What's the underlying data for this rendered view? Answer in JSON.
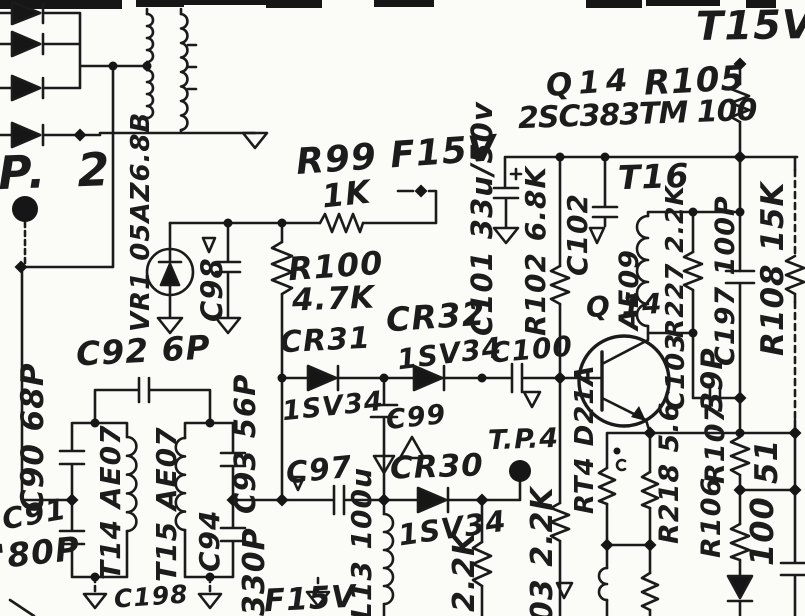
{
  "meta": {
    "figure_type": "hand-drawn circuit schematic (scanned)",
    "ink_color": "#1a1a1a",
    "paper_color": "#fbfbf8",
    "supply_rails": [
      "T15V",
      "F15V"
    ],
    "test_points": [
      "P. 2",
      "T.P.4"
    ]
  },
  "labels": {
    "tp2": "P. 2",
    "t15v": "T15V",
    "q14": "Q14",
    "r105": "R105",
    "q14_type": "2SC383TM 100",
    "t16": "T16",
    "q14_marker": "Q 14",
    "r99": "R99 F15V",
    "r99_value": "1K",
    "r100": "R100",
    "r100_value": "4.7K",
    "vr1": "VR1 05AZ6.8B",
    "c98": "C98",
    "c92": "C92 6P",
    "c90": "C90 68P",
    "c91": "C91",
    "c91_value": "'80P",
    "t14": "T14 AE07",
    "t15": "T15 AE07",
    "c94": "C94",
    "c94_value": "330P",
    "c93": "C93 56P",
    "c198": "C198",
    "f15v_bottom": "F15V",
    "l13": "L13 100u",
    "cr31": "CR31",
    "cr31_type": "1SV34",
    "cr32": "CR32",
    "cr32_type": "1SV34",
    "c100": "C100",
    "c97": "C97",
    "c99": "C99",
    "cr30": "CR30",
    "cr30_type": "1SV34",
    "tp4": "T.P.4",
    "r_2k2": "2.2K",
    "r103": "03 2.2K",
    "rt4": "RT4 D21A",
    "r218": "R218 5.6",
    "c103": "C103",
    "r107": "R107",
    "r107_value": "51",
    "r106": "R106",
    "r106_value": "100",
    "c197": "C197 100P",
    "c39p": "39P",
    "r108": "R108 15K",
    "c101": "C101 33u/50v",
    "r102": "R102 6.8K",
    "c102": "C102",
    "ae09": "AE09",
    "r227": "R227 2.2K"
  }
}
